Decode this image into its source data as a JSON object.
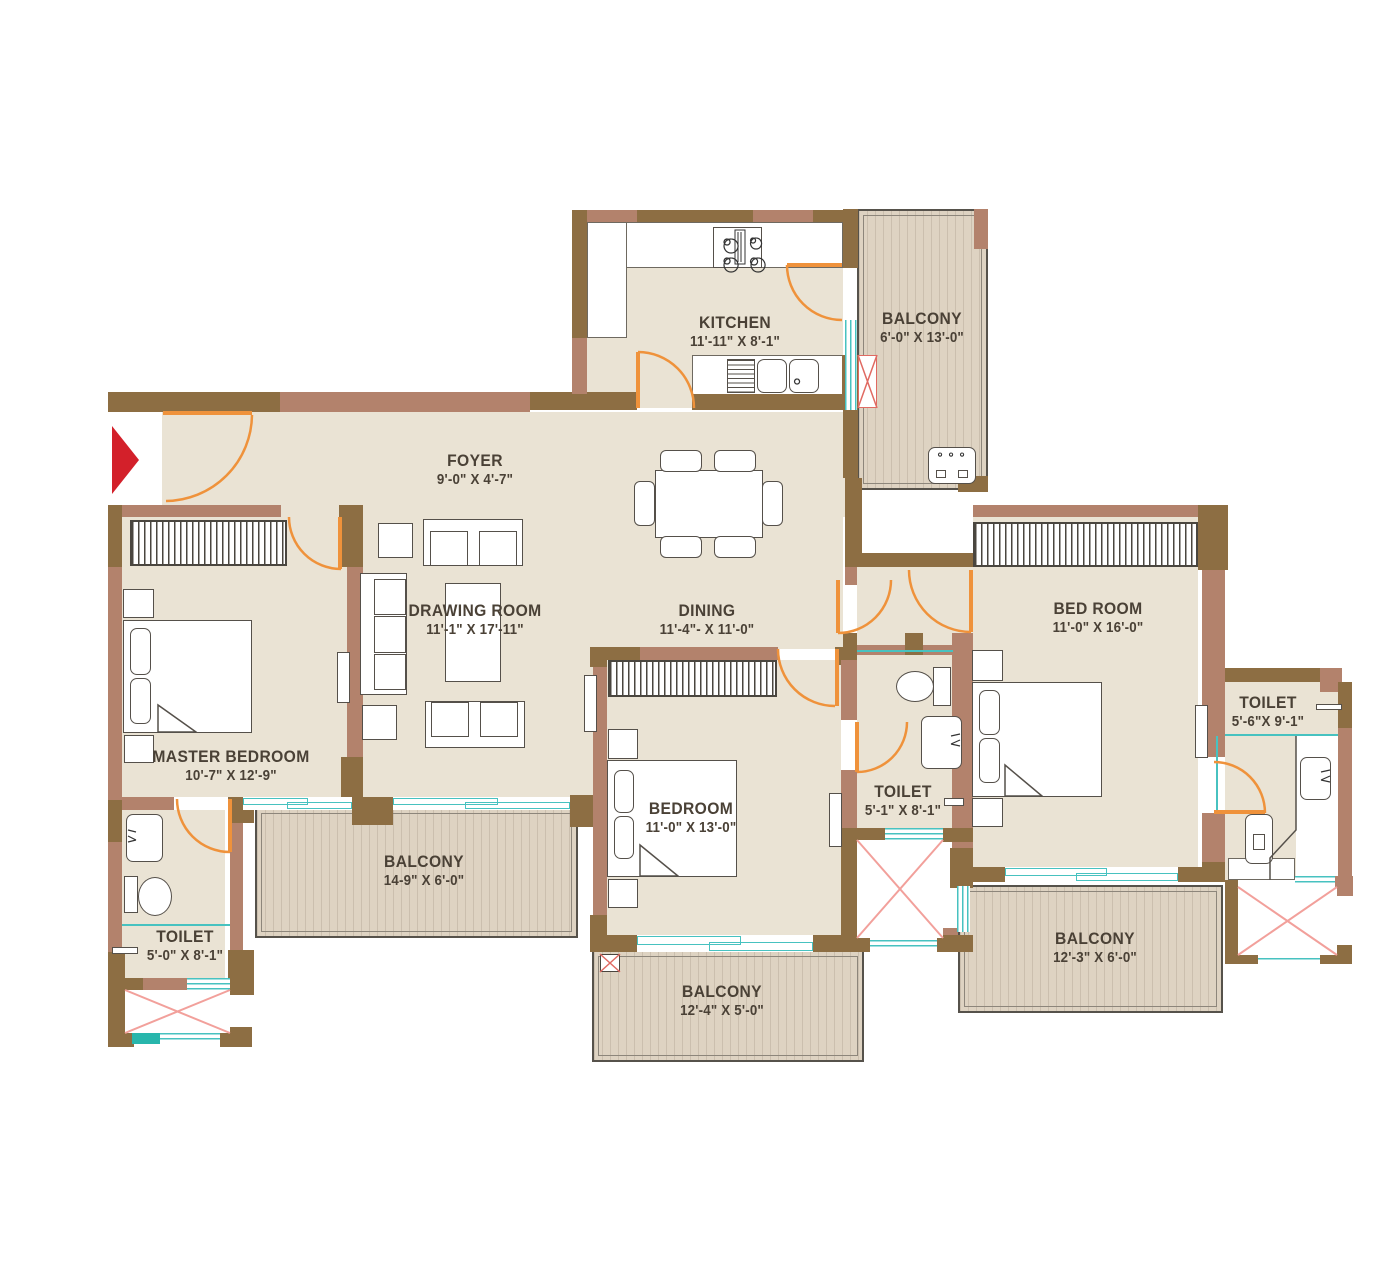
{
  "rooms": {
    "kitchen": {
      "name": "KITCHEN",
      "dims": "11'-11\" X 8'-1\""
    },
    "kitchen_balcony": {
      "name": "BALCONY",
      "dims": "6'-0\" X 13'-0\""
    },
    "foyer": {
      "name": "FOYER",
      "dims": "9'-0\" X 4'-7\""
    },
    "drawing_room": {
      "name": "DRAWING ROOM",
      "dims": "11'-1\" X 17'-11\""
    },
    "dining": {
      "name": "DINING",
      "dims": "11'-4\"- X 11'-0\""
    },
    "master_bedroom": {
      "name": "MASTER BEDROOM",
      "dims": "10'-7\" X 12'-9\""
    },
    "master_toilet": {
      "name": "TOILET",
      "dims": "5'-0\" X 8'-1\""
    },
    "drawing_balcony": {
      "name": "BALCONY",
      "dims": "14-9\" X 6'-0\""
    },
    "bedroom2": {
      "name": "BEDROOM",
      "dims": "11'-0\" X 13'-0\""
    },
    "bedroom2_balcony": {
      "name": "BALCONY",
      "dims": "12'-4\" X 5'-0\""
    },
    "toilet2": {
      "name": "TOILET",
      "dims": "5'-1\" X 8'-1\""
    },
    "bedroom3": {
      "name": "BED ROOM",
      "dims": "11'-0\" X 16'-0\""
    },
    "toilet3": {
      "name": "TOILET",
      "dims": "5'-6\"X 9'-1\""
    },
    "bedroom3_balcony": {
      "name": "BALCONY",
      "dims": "12'-3\" X 6'-0\""
    }
  },
  "legend": {
    "entry_marker": "main entry"
  },
  "colors": {
    "wall_dark": "#8d6e43",
    "wall_light": "#b3826c",
    "floor": "#eae3d4",
    "balcony_floor": "#ded3c2",
    "door": "#ef923b",
    "window": "#47c2c0",
    "shaft_cross": "#f2a09b",
    "entry_arrow": "#d3202a",
    "label_text": "#4a4136"
  }
}
